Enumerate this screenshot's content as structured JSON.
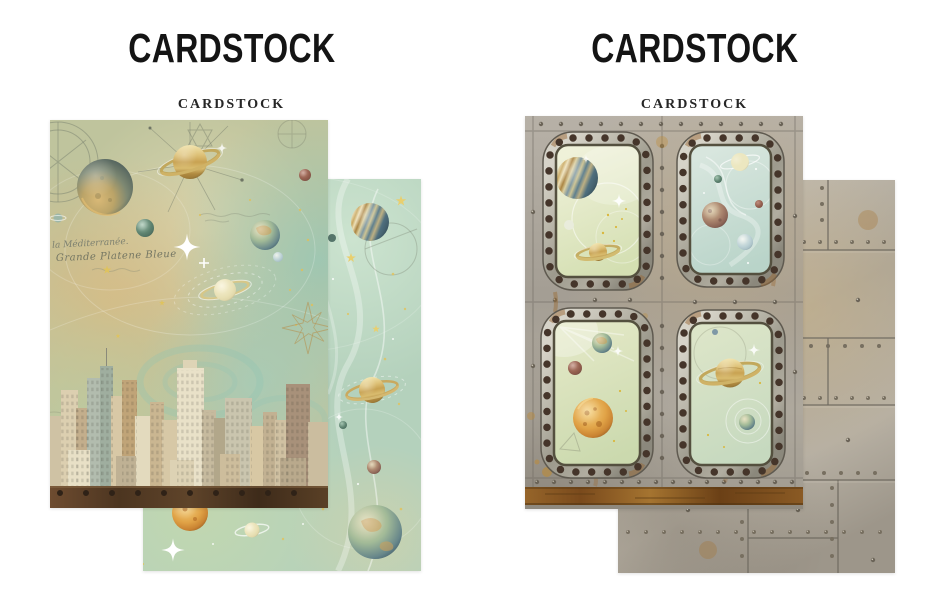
{
  "page": {
    "background": "#ffffff"
  },
  "products": [
    {
      "id": "space-city-cardstock",
      "title": "CARDSTOCK",
      "subtitle": "CARDSTOCK",
      "front_sheet": "vintage-space-city-skyline-sheet",
      "back_sheet": "teal-planets-swirl-sheet",
      "script_lines": [
        "à la Méditerranée.",
        "Grande Platene Bleue"
      ]
    },
    {
      "id": "metal-porthole-cardstock",
      "title": "CARDSTOCK",
      "subtitle": "CARDSTOCK",
      "front_sheet": "riveted-porthole-planets-sheet",
      "back_sheet": "riveted-metal-plates-sheet"
    }
  ],
  "colors": {
    "heading": "#141414",
    "sheet_sage": "#c0c49e",
    "sheet_teal": "#b4d1bc",
    "sheet_cream": "#dad3ae",
    "metal_gray": "#aaa49a",
    "rust_band": "#8a5a24",
    "porthole_frame": "#b6b3a6",
    "window_mint": "#d6dfc0",
    "beam_brown": "#4c3520",
    "rivet_brown": "#45352a"
  }
}
